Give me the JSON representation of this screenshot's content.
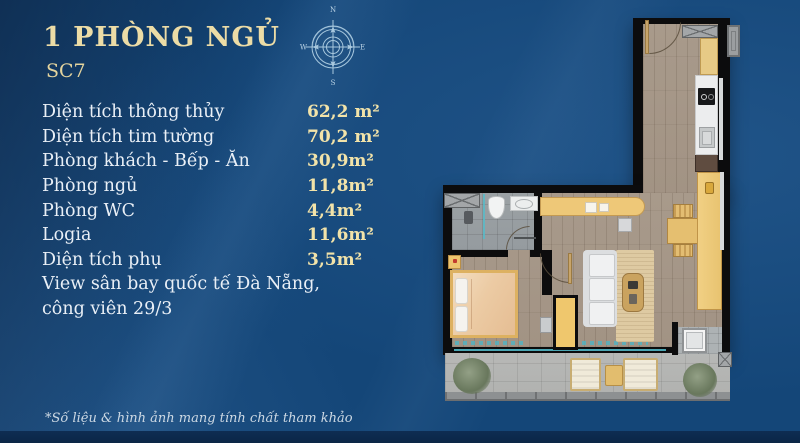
{
  "page": {
    "title": "1 PHÒNG NGỦ",
    "subtitle": "SC7",
    "footnote": "*Số liệu & hình ảnh mang tính chất tham khảo"
  },
  "compass": {
    "n": "N",
    "e": "E",
    "s": "S",
    "w": "W"
  },
  "specs": {
    "rows": [
      {
        "label": "Diện tích thông thủy",
        "value": "62,2 m²"
      },
      {
        "label": "Diện tích tim tường",
        "value": "70,2 m²"
      },
      {
        "label": "Phòng khách - Bếp - Ăn",
        "value": "30,9m²"
      },
      {
        "label": "Phòng ngủ",
        "value": "11,8m²"
      },
      {
        "label": "Phòng WC",
        "value": "4,4m²"
      },
      {
        "label": "Logia",
        "value": "11,6m²"
      },
      {
        "label": "Diện tích phụ",
        "value": "3,5m²"
      }
    ],
    "note_lines": [
      "View sân bay quốc tế Đà Nẵng,",
      "công viên 29/3"
    ]
  },
  "colors": {
    "background_blue": "#144678",
    "title_gold": "#ecdca6",
    "value_gold": "#f2e3a9",
    "label_white": "#e9eff6",
    "compass_line": "#a8c8de",
    "wall_black": "#0c0c0d",
    "glass_teal": "#52b7c5"
  }
}
